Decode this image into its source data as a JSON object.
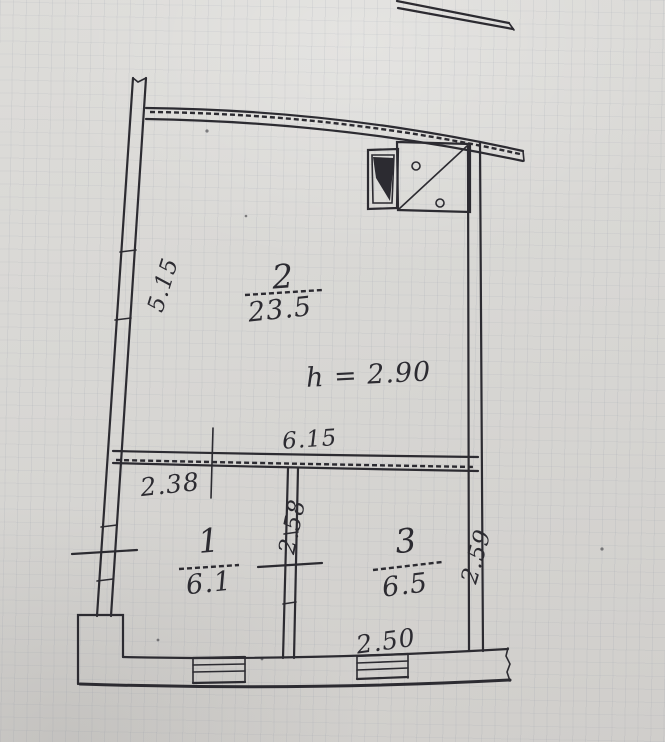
{
  "plan": {
    "title": "apartment-floor-plan-scan",
    "ceiling_height": "h = 2.90",
    "rooms": [
      {
        "number": "2",
        "area": "23.5"
      },
      {
        "number": "1",
        "area": "6.1"
      },
      {
        "number": "3",
        "area": "6.5"
      }
    ],
    "dimensions": {
      "left_wall": "5.15",
      "room2_width": "6.15",
      "room1_width": "2.38",
      "partition_1_3": "2.58",
      "room3_depth": "2.59",
      "room3_width": "2.50"
    },
    "colors": {
      "paper": "#d8d7d4",
      "ink": "#2c2b31"
    }
  }
}
